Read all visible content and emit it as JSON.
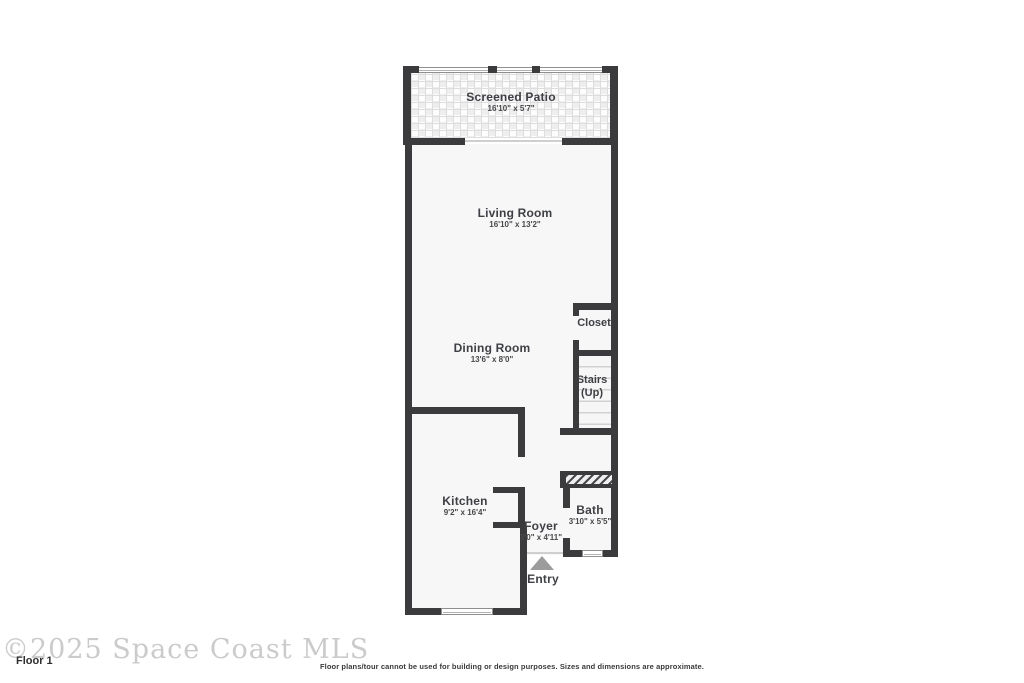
{
  "watermark": "©2025 Space Coast MLS",
  "floor_label": "Floor 1",
  "disclaimer": "Floor plans/tour cannot be used for building or design purposes. Sizes and dimensions are approximate.",
  "rooms": {
    "patio": {
      "name": "Screened Patio",
      "dims": "16'10\" x 5'7\""
    },
    "living": {
      "name": "Living Room",
      "dims": "16'10\" x 13'2\""
    },
    "closet": {
      "name": "Closet"
    },
    "dining": {
      "name": "Dining Room",
      "dims": "13'6\" x 8'0\""
    },
    "stairs": {
      "name": "Stairs",
      "direction": "(Up)"
    },
    "kitchen": {
      "name": "Kitchen",
      "dims": "9'2\" x 16'4\""
    },
    "foyer": {
      "name": "Foyer",
      "dims": "3'0\" x 4'11\""
    },
    "bath": {
      "name": "Bath",
      "dims": "3'10\" x 5'5\""
    },
    "entry": {
      "name": "Entry"
    }
  },
  "colors": {
    "wall": "#3b3b3d",
    "room_fill": "#f7f7f7",
    "label_text": "#3f4045",
    "watermark_text": "#cbcbcb",
    "entry_arrow": "#9c9c9c"
  }
}
